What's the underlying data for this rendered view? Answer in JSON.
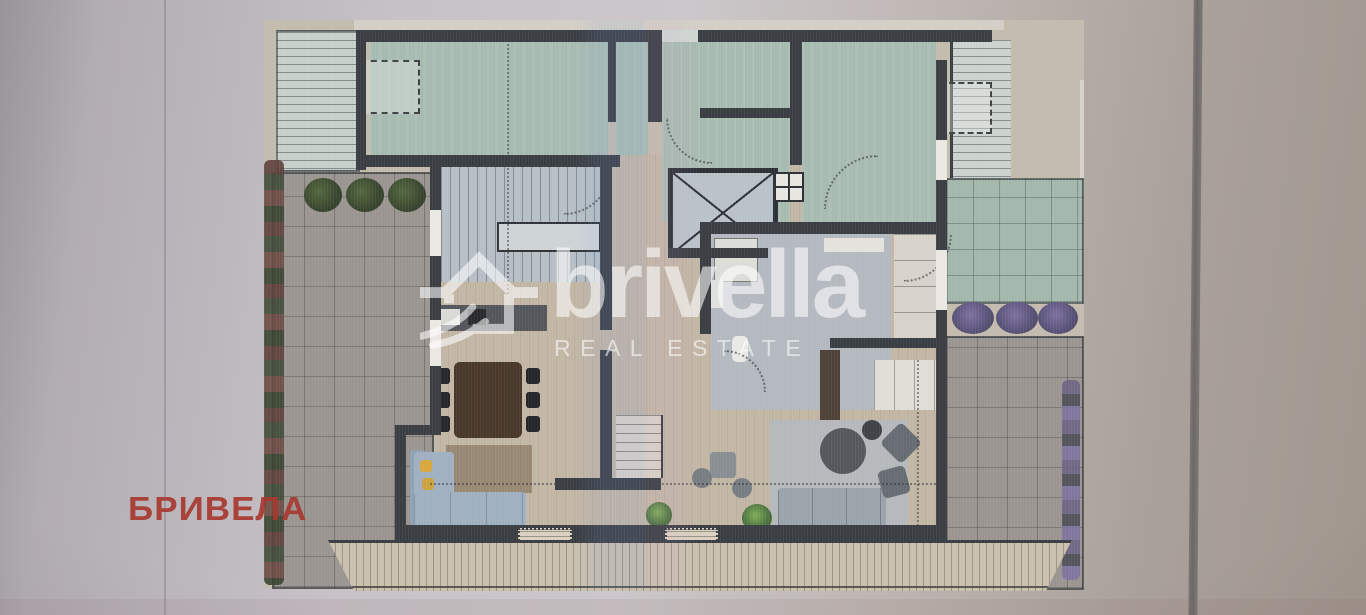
{
  "watermark": {
    "brand": "brivella",
    "tagline": "REAL ESTATE",
    "icon": "house-logo-icon",
    "color": "#ffffff"
  },
  "stamp": {
    "text": "БРИВЕЛА",
    "color": "#a8392f"
  },
  "floor_plan": {
    "palette": {
      "wall": "#3a3e43",
      "roof_green": "#a7bab0",
      "green_tile": "#a3b7ac",
      "gray_tile": "#9a9590",
      "wood_floor": "#c2b6a5",
      "stair_blue": "#b6bfc5",
      "sofa_blue": "#9fb0c1",
      "table_brown": "#49382a",
      "pillow_yellow": "#d9a83c",
      "plant_dark_green": "#39462f",
      "plant_purple": "#5b547a",
      "flower_red": "#5d3f3a"
    }
  }
}
